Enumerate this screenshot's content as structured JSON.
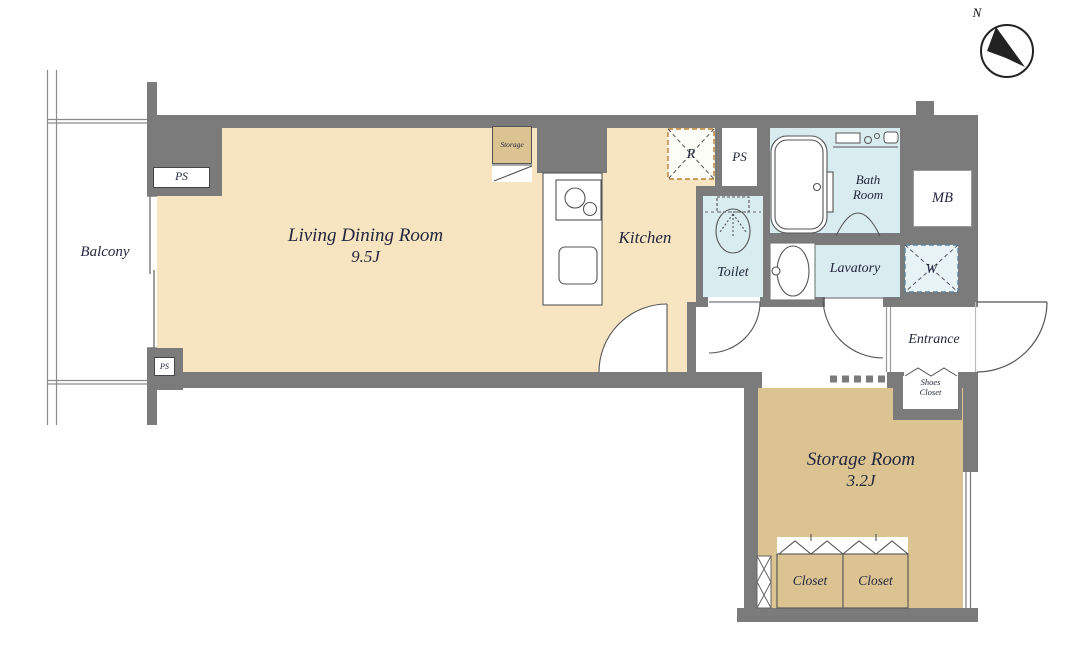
{
  "title": "Apartment floor plan",
  "compass": {
    "north_label": "N"
  },
  "rooms": {
    "balcony": {
      "name": "Balcony"
    },
    "living_dining": {
      "name": "Living Dining Room",
      "size": "9.5J"
    },
    "kitchen": {
      "name": "Kitchen"
    },
    "toilet": {
      "name": "Toilet"
    },
    "bath": {
      "name_line1": "Bath",
      "name_line2": "Room"
    },
    "lavatory": {
      "name": "Lavatory"
    },
    "entrance": {
      "name": "Entrance"
    },
    "storage_room": {
      "name": "Storage Room",
      "size": "3.2J"
    },
    "closets": [
      {
        "name": "Closet"
      },
      {
        "name": "Closet"
      }
    ]
  },
  "fixtures": {
    "pipe_shaft_top": "PS",
    "pipe_shaft_mid": "PS",
    "pipe_shaft_small": "PS",
    "kitchen_storage": "Storage",
    "refrigerator_space": "R",
    "washer_space": "W",
    "meter_box": "MB",
    "shoes_closet_line1": "Shoes",
    "shoes_closet_line2": "Closet"
  },
  "colors": {
    "wall": "#7b7b7b",
    "floor_main": "#f7e5c1",
    "floor_storage": "#dcc492",
    "floor_wet": "#d9ecef",
    "refrigerator_dash": "#b5813d",
    "washer_dash": "#5d849b",
    "text": "#23263d"
  }
}
